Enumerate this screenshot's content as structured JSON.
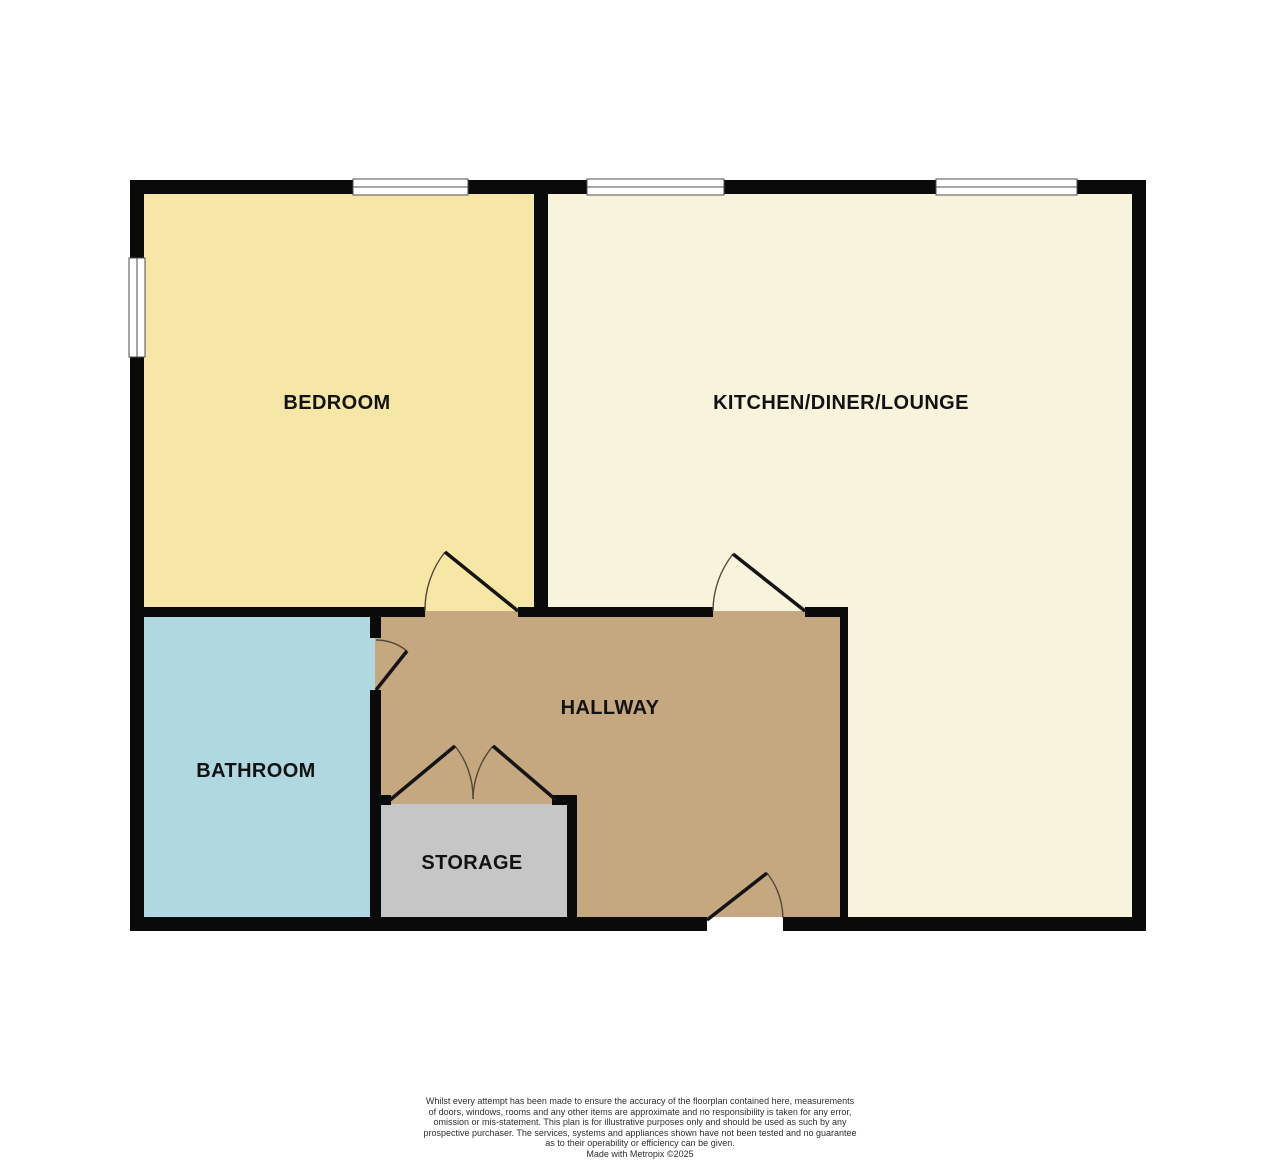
{
  "plan": {
    "wall_color": "#0a0a0a",
    "label_color": "#121212",
    "rooms": [
      {
        "id": "bedroom",
        "label": "BEDROOM",
        "color": "#F7E7A7"
      },
      {
        "id": "kitchen-diner-lounge",
        "label": "KITCHEN/DINER/LOUNGE",
        "color": "#F8F3DC"
      },
      {
        "id": "bathroom",
        "label": "BATHROOM",
        "color": "#B0D8E1"
      },
      {
        "id": "hallway",
        "label": "HALLWAY",
        "color": "#C5A87F"
      },
      {
        "id": "storage",
        "label": "STORAGE",
        "color": "#C7C6C6"
      }
    ]
  },
  "footer": {
    "disclaimer_lines": [
      "Whilst every attempt has been made to ensure the accuracy of the floorplan contained here, measurements",
      "of doors, windows, rooms and any other items are approximate and no responsibility is taken for any error,",
      "omission or mis-statement. This plan is for illustrative purposes only and should be used as such by any",
      "prospective purchaser. The services, systems and appliances shown have not been tested and no guarantee",
      "as to their operability or efficiency can be given."
    ],
    "credit": "Made with Metropix ©2025"
  }
}
